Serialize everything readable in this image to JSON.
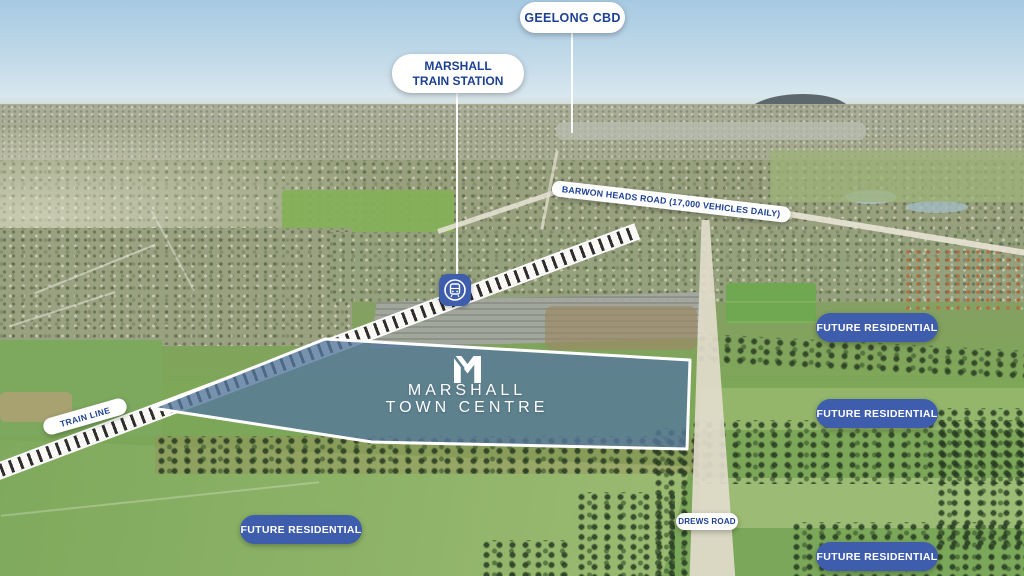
{
  "colors": {
    "label_text_navy": "#1c4193",
    "pill_blue": "#3e5dad",
    "site_highlight_fill": "#56789c",
    "label_white": "#ffffff"
  },
  "callouts": {
    "geelong_cbd": "GEELONG CBD",
    "marshall_station_line1": "MARSHALL",
    "marshall_station_line2": "TRAIN STATION",
    "barwon_heads_road": "BARWON HEADS ROAD (17,000 VEHICLES DAILY)",
    "train_line": "TRAIN LINE",
    "drews_road": "DREWS ROAD"
  },
  "site": {
    "logo": "marshall-m-monogram",
    "name_line1": "MARSHALL",
    "name_line2": "TOWN CENTRE"
  },
  "future_pills": [
    {
      "id": "right-upper",
      "label": "FUTURE RESIDENTIAL"
    },
    {
      "id": "right-middle",
      "label": "FUTURE RESIDENTIAL"
    },
    {
      "id": "bottom-left",
      "label": "FUTURE RESIDENTIAL"
    },
    {
      "id": "bottom-right",
      "label": "FUTURE RESIDENTIAL"
    }
  ],
  "icons": {
    "train_station_badge": "train-station-icon"
  }
}
